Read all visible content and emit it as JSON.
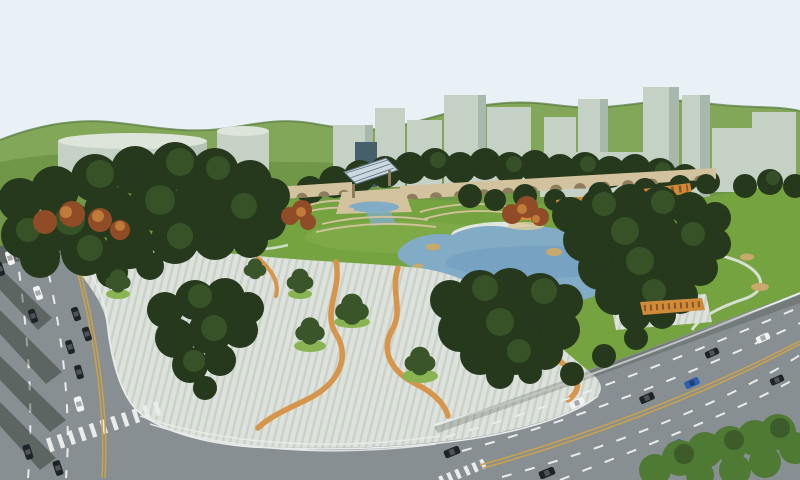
{
  "scene": {
    "type": "3d-architectural-rendering",
    "subject": "Aerial bird's-eye rendering of an urban park master plan with central lake, striped pedestrian plaza, arched colonnade wall, perimeter boulevards and city building massing under green hills",
    "text_visible": "none"
  },
  "colors": {
    "sky": "#e9f1f7",
    "hill_far": "#83a758",
    "hill_near": "#6f9747",
    "hill_edge": "#54783a",
    "building_face": "#c6d1c6",
    "building_top": "#dde4da",
    "building_side": "#a9b8ac",
    "building_glass": "#46606a",
    "tree_dark": "#26391d",
    "tree_mid": "#3a5529",
    "tree_light": "#4e7a33",
    "tree_autumn": "#8f4c26",
    "tree_autumn_light": "#c07a3a",
    "lawn": "#74a33f",
    "lawn_light": "#8ab452",
    "lake": "#82abc6",
    "lake_deep": "#6e9abb",
    "beach_white": "#e2e6e1",
    "sand": "#d8c89e",
    "rock": "#c9a96b",
    "wall": "#d2c39e",
    "wall_arch": "#8d7d5c",
    "canopy_glass": "#ccd9e2",
    "pergola": "#cf8a3a",
    "plaza": "#dde2dc",
    "plaza_stripe": "#c9d1c8",
    "path_accent": "#d6954a",
    "road": "#878f93",
    "marking_white": "#e9eceb",
    "marking_yellow": "#c8a14e",
    "car_white": "#f0f3f3",
    "car_black": "#1d2327",
    "car_blue": "#2d5fae",
    "shadow": "rgba(25,35,22,0.38)"
  },
  "inventory": {
    "cars_total": 21,
    "car_colors": [
      "white",
      "black",
      "blue"
    ],
    "roads": 2,
    "crosswalks": 2,
    "lakes": 1,
    "building_blocks": 16,
    "pergolas": 2,
    "arched_wall_sections": 2
  }
}
